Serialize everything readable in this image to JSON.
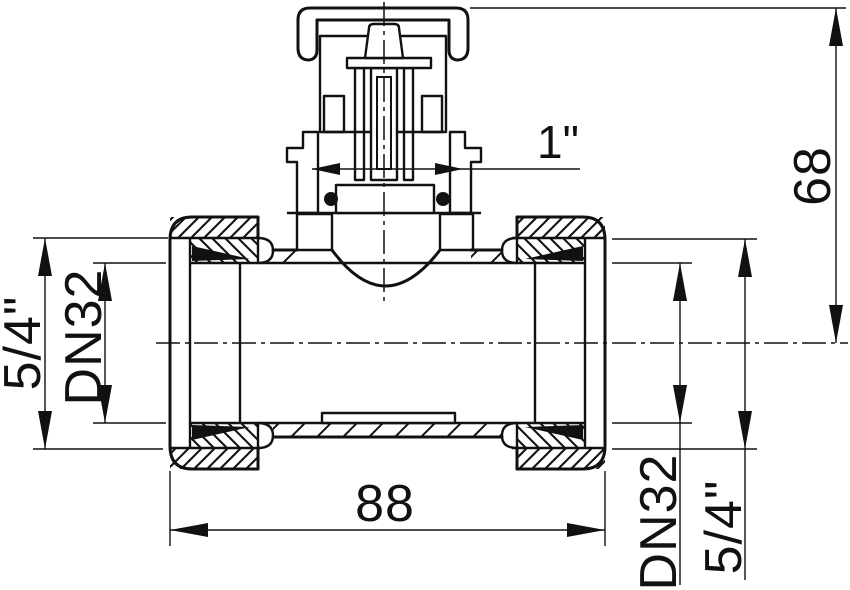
{
  "drawing": {
    "type": "valve-tee-fitting-cross-section",
    "labels": {
      "valve_thread": "1\"",
      "overall_height": "68",
      "left_port_thread": "5/4\"",
      "left_port_bore": "DN32",
      "overall_length": "88",
      "right_port_bore": "DN32",
      "right_port_thread": "5/4\""
    },
    "colors": {
      "ink": "#111111",
      "paper": "#ffffff"
    }
  }
}
